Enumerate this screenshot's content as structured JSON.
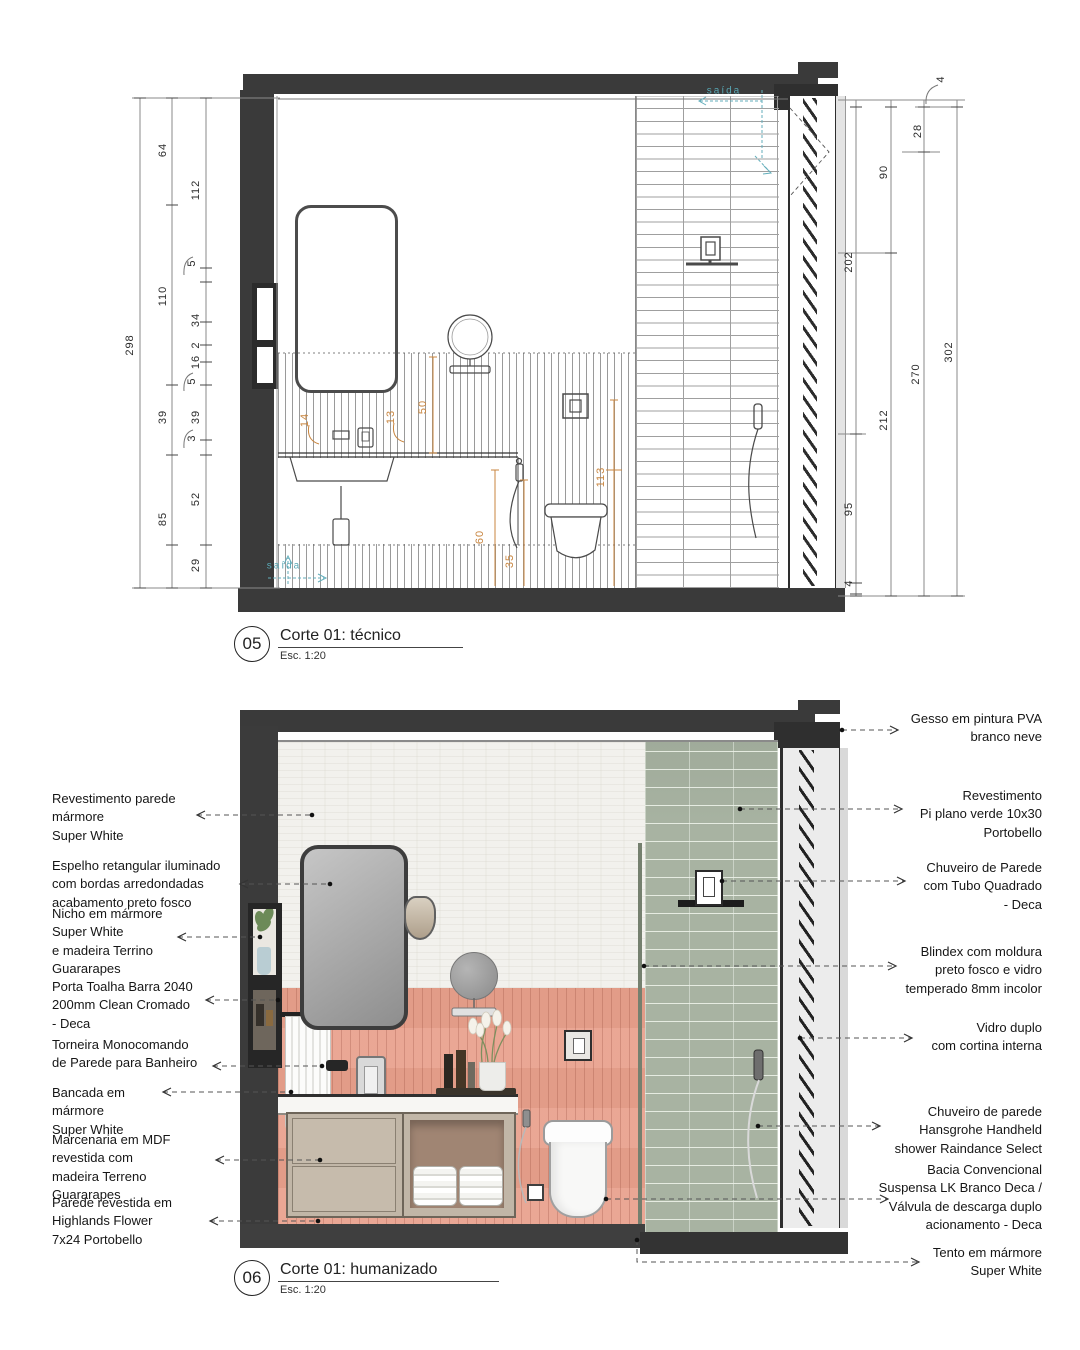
{
  "colors": {
    "structure": "#3a3a3a",
    "pink_tile": "#e9a28e",
    "green_tile": "#a8b3a2",
    "marble": "#f2f1ed",
    "flow_teal": "#58a7b4",
    "inner_dim_orange": "#c8853f"
  },
  "tecnico": {
    "number": "05",
    "title": "Corte 01: técnico",
    "scale": "Esc. 1:20",
    "dimensions": [
      {
        "t": "298",
        "x": 130,
        "y": 345
      },
      {
        "t": "64",
        "x": 163,
        "y": 150
      },
      {
        "t": "112",
        "x": 196,
        "y": 190
      },
      {
        "t": "5",
        "x": 192,
        "y": 263
      },
      {
        "t": "110",
        "x": 163,
        "y": 296
      },
      {
        "t": "34",
        "x": 196,
        "y": 320
      },
      {
        "t": "2",
        "x": 196,
        "y": 345
      },
      {
        "t": "16",
        "x": 196,
        "y": 362
      },
      {
        "t": "5",
        "x": 192,
        "y": 381
      },
      {
        "t": "39",
        "x": 163,
        "y": 417
      },
      {
        "t": "39",
        "x": 196,
        "y": 417
      },
      {
        "t": "3",
        "x": 192,
        "y": 438
      },
      {
        "t": "52",
        "x": 196,
        "y": 499
      },
      {
        "t": "85",
        "x": 163,
        "y": 519
      },
      {
        "t": "29",
        "x": 196,
        "y": 565
      },
      {
        "t": "4",
        "x": 941,
        "y": 79
      },
      {
        "t": "28",
        "x": 918,
        "y": 131
      },
      {
        "t": "90",
        "x": 884,
        "y": 172
      },
      {
        "t": "202",
        "x": 849,
        "y": 262
      },
      {
        "t": "270",
        "x": 916,
        "y": 374
      },
      {
        "t": "302",
        "x": 949,
        "y": 352
      },
      {
        "t": "212",
        "x": 884,
        "y": 420
      },
      {
        "t": "95",
        "x": 849,
        "y": 509
      },
      {
        "t": "4",
        "x": 849,
        "y": 583
      }
    ],
    "inner_dimensions": [
      {
        "t": "14",
        "x": 305,
        "y": 420
      },
      {
        "t": "13",
        "x": 391,
        "y": 417
      },
      {
        "t": "50",
        "x": 423,
        "y": 407
      },
      {
        "t": "113",
        "x": 601,
        "y": 477
      },
      {
        "t": "60",
        "x": 480,
        "y": 537
      },
      {
        "t": "35",
        "x": 510,
        "y": 561
      }
    ],
    "flow_labels": [
      {
        "t": "saída",
        "x": 724,
        "y": 91
      },
      {
        "t": "saída",
        "x": 284,
        "y": 566
      }
    ]
  },
  "humanizado": {
    "number": "06",
    "title": "Corte 01: humanizado",
    "scale": "Esc. 1:20",
    "callouts_left": [
      {
        "text": "Revestimento parede\nmármore\nSuper White",
        "x": 52,
        "y": 790,
        "leader": {
          "x1": 197,
          "x2": 312,
          "y": 815
        }
      },
      {
        "text": "Espelho retangular iluminado\ncom bordas arredondadas\nacabamento preto fosco",
        "x": 52,
        "y": 857,
        "leader": {
          "x1": 240,
          "x2": 330,
          "y": 884
        }
      },
      {
        "text": "Nicho em mármore\nSuper White\ne madeira Terrino\nGuararapes",
        "x": 52,
        "y": 905,
        "leader": {
          "x1": 178,
          "x2": 260,
          "y": 937
        }
      },
      {
        "text": "Porta Toalha Barra 2040\n200mm Clean Cromado\n - Deca",
        "x": 52,
        "y": 978,
        "leader": {
          "x1": 206,
          "x2": 278,
          "y": 1000
        }
      },
      {
        "text": "Torneira Monocomando\nde Parede para Banheiro",
        "x": 52,
        "y": 1036,
        "leader": {
          "x1": 213,
          "x2": 322,
          "y": 1066
        }
      },
      {
        "text": "Bancada em\nmármore\nSuper White",
        "x": 52,
        "y": 1084,
        "leader": {
          "x1": 163,
          "x2": 291,
          "y": 1092
        }
      },
      {
        "text": "Marcenaria em MDF\nrevestida com\nmadeira Terreno\nGuararapes",
        "x": 52,
        "y": 1131,
        "leader": {
          "x1": 216,
          "x2": 320,
          "y": 1160
        }
      },
      {
        "text": "Parede revestida em\nHighlands Flower\n7x24 Portobello",
        "x": 52,
        "y": 1194,
        "leader": {
          "x1": 210,
          "x2": 318,
          "y": 1221
        }
      }
    ],
    "callouts_right": [
      {
        "text": "Gesso em pintura PVA\nbranco neve",
        "x": 1042,
        "y": 710,
        "leader": {
          "x1": 842,
          "x2": 898,
          "y": 730
        }
      },
      {
        "text": "Revestimento\nPi plano verde 10x30\nPortobello",
        "x": 1042,
        "y": 787,
        "leader": {
          "x1": 740,
          "x2": 902,
          "y": 809
        }
      },
      {
        "text": "Chuveiro de Parede\ncom Tubo Quadrado\n- Deca",
        "x": 1042,
        "y": 859,
        "leader": {
          "x1": 722,
          "x2": 905,
          "y": 881
        }
      },
      {
        "text": "Blindex com moldura\npreto fosco  e vidro\ntemperado 8mm incolor",
        "x": 1042,
        "y": 943,
        "leader": {
          "x1": 644,
          "x2": 896,
          "y": 966
        }
      },
      {
        "text": "Vidro duplo\ncom cortina interna",
        "x": 1042,
        "y": 1019,
        "leader": {
          "x1": 800,
          "x2": 912,
          "y": 1038
        }
      },
      {
        "text": "Chuveiro de parede\nHansgrohe Handheld\nshower Raindance Select",
        "x": 1042,
        "y": 1103,
        "leader": {
          "x1": 758,
          "x2": 880,
          "y": 1126
        }
      },
      {
        "text": "Bacia Convencional\nSuspensa LK Branco Deca /\nVálvula de descarga duplo\nacionamento - Deca",
        "x": 1042,
        "y": 1161,
        "leader": {
          "x1": 606,
          "x2": 888,
          "y": 1199
        }
      },
      {
        "text": "Tento em mármore\nSuper White",
        "x": 1042,
        "y": 1244,
        "leader": {
          "poly": [
            [
              637,
              1240
            ],
            [
              637,
              1262
            ],
            [
              919,
              1262
            ]
          ]
        }
      }
    ]
  }
}
